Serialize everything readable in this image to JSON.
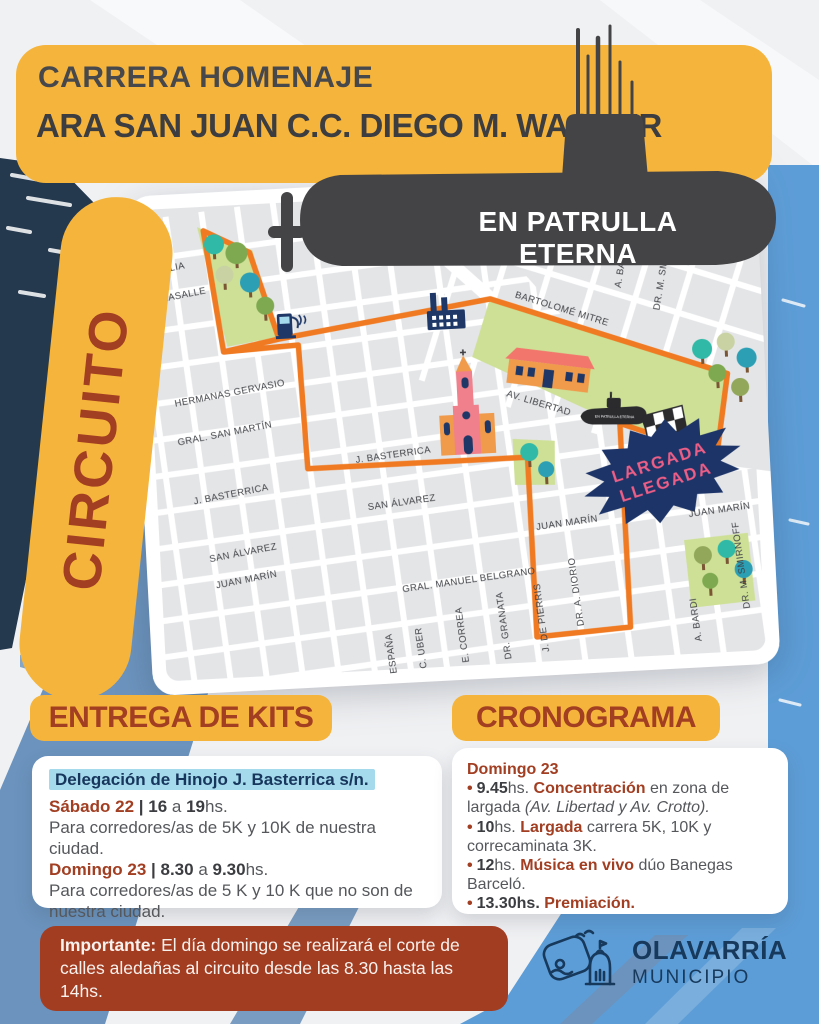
{
  "poster": {
    "banner": {
      "line1": "CARRERA HOMENAJE",
      "line2": "ARA SAN JUAN C.C. DIEGO M. WAGNER"
    },
    "submarine_motto": "EN PATRULLA ETERNA",
    "circuit_label": "CIRCUITO"
  },
  "map": {
    "street_labels": [
      "C. ITALIA",
      "L. LASALLE",
      "HERMANAS GERVASIO",
      "GRAL. SAN MARTÍN",
      "J. BASTERRICA",
      "J. BASTERRICA",
      "SAN ÁLVAREZ",
      "SAN ÁLVAREZ",
      "JUAN MARÍN",
      "JUAN MARÍN",
      "JUAN MARÍN",
      "GRAL. MANUEL BELGRANO",
      "ESPAÑA",
      "C. UBER",
      "E. CORREA",
      "DR. GRANATA",
      "J. DE PIERRIS",
      "DR. A. DIORIO",
      "A. BARDI",
      "DR. M. SMIRNOFF",
      "A. BARDI",
      "DR. M. SMIRNOFF",
      "D. REY",
      "AV. CROTTO",
      "BARTOLOMÉ MITRE",
      "AV. LIBERTAD"
    ],
    "start_finish": {
      "line1": "LARGADA",
      "line2": "LLEGADA"
    },
    "monument_label": "EN PATRULLA ETERNA"
  },
  "kits": {
    "heading": "ENTREGA DE KITS",
    "location": "Delegación de Hinojo J. Basterrica s/n.",
    "slots": [
      {
        "day": "Sábado 22",
        "sep": " | ",
        "from": "16",
        "mid": " a ",
        "to": "19",
        "hs": "hs.",
        "desc": "Para corredores/as de 5K y 10K de nuestra ciudad."
      },
      {
        "day": "Domingo 23",
        "sep": " | ",
        "from": "8.30",
        "mid": " a ",
        "to": "9.30",
        "hs": "hs.",
        "desc": "Para corredores/as de 5 K y 10 K que no son de nuestra ciudad."
      }
    ]
  },
  "schedule": {
    "heading": "CRONOGRAMA",
    "day": "Domingo 23",
    "bullet": "•",
    "items": [
      {
        "time": "9.45",
        "hs": "hs. ",
        "highlight": "Concentración",
        "rest": " en zona de largada ",
        "italic": "(Av. Libertad y Av. Crotto)."
      },
      {
        "time": "10",
        "hs": "hs. ",
        "highlight": "Largada",
        "rest": " carrera 5K, 10K y correcaminata 3K.",
        "italic": ""
      },
      {
        "time": "12",
        "hs": "hs. ",
        "highlight": "Música en vivo",
        "rest": " dúo Banegas Barceló.",
        "italic": ""
      },
      {
        "time": "13.30hs.",
        "hs": " ",
        "highlight": "Premiación.",
        "rest": "",
        "italic": ""
      }
    ]
  },
  "notice": {
    "label": "Importante:",
    "text": " El día domingo se realizará el corte de calles aledañas al circuito desde las 8.30 hasta las 14hs."
  },
  "logo": {
    "city": "OLAVARRÍA",
    "subtitle": "MUNICIPIO"
  },
  "colors": {
    "yellow": "#F5B43B",
    "heading_red": "#A23E22",
    "navy": "#1E3766",
    "route_orange": "#F07A22",
    "light_blue": "#5D9DD7",
    "steel_blue": "#6B93BD",
    "park_green": "#CDE096",
    "star_navy": "#1C3468",
    "star_pink": "#ED5E86",
    "highlight_cyan": "#A5DAEC",
    "notice_red": "#A33D22"
  }
}
